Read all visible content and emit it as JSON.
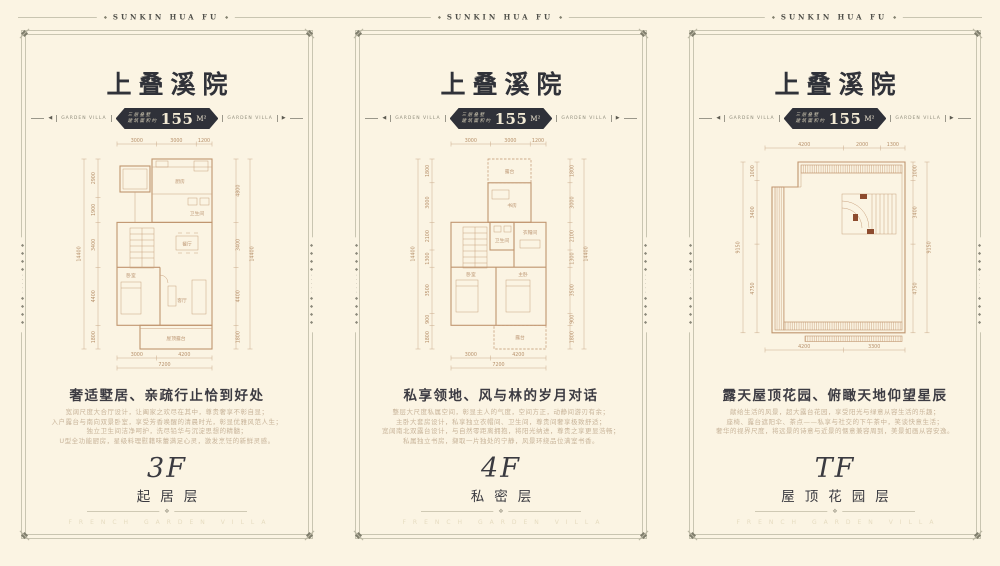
{
  "page": {
    "brand": "SUNKIN HUA FU",
    "icons": {
      "diamond": "◆",
      "left_arrow": "◀",
      "right_arrow": "▶",
      "divider_ornament": "❖",
      "side_ornament": "◆◆◆◆·····◆◆◆◆"
    }
  },
  "panels": [
    {
      "title": "上叠溪院",
      "side_label": "GARDEN VILLA",
      "badge": {
        "line1": "三层叠墅",
        "line2": "建筑面积约",
        "area": "155",
        "unit": "M²"
      },
      "headline": "奢适墅居、亲疏行止恰到好处",
      "body": [
        "宽阔尺度大合厅设计，让阖家之欢尽在其中，尊贵奢享不彰自显；",
        "入户露台与南向双景卧室，享受芳香唤醒的清晨时光，彰显优雅风范人生；",
        "独立卫生间洁净呵护，洗尽铅华与沉淀思想的精髓；",
        "U型全功能厨房，星级料理慰藉味蕾满足心灵，激发烹饪的新鲜灵感。"
      ],
      "floor_code": "3F",
      "floor_name": "起居层",
      "caption": "FRENCH GARDEN VILLA",
      "plan": {
        "top": [
          "3000",
          "3000",
          "1200"
        ],
        "left_total": "14400",
        "left": [
          "2900",
          "1900",
          "3400",
          "4400",
          "1800"
        ],
        "right": [
          "4800",
          "3400",
          "4400",
          "1800"
        ],
        "right_total": "14400",
        "bottom": [
          "3000",
          "4200"
        ],
        "bottom_total": "7200",
        "rooms": [
          "厨房",
          "卫生间",
          "餐厅",
          "卧室",
          "客厅",
          "屋顶露台"
        ]
      }
    },
    {
      "title": "上叠溪院",
      "side_label": "GARDEN VILLA",
      "badge": {
        "line1": "三层叠墅",
        "line2": "建筑面积约",
        "area": "155",
        "unit": "M²"
      },
      "headline": "私享领地、风与林的岁月对话",
      "body": [
        "整层大尺度私属空间，彰显主人的气度，空间方正，动静间游刃有余；",
        "主卧大套房设计，私享独立衣帽间、卫生间，尊贵间奢享极致舒适；",
        "宽阔南北双露台设计，与自然零距离拥抱，将阳光纳进，尊贵之享更显浩畅；",
        "私属独立书房，撷取一片独处的宁静，风景环绕品位满室书香。"
      ],
      "floor_code": "4F",
      "floor_name": "私密层",
      "caption": "FRENCH GARDEN VILLA",
      "plan": {
        "top": [
          "3000",
          "3000",
          "1200"
        ],
        "left_total": "14400",
        "left": [
          "1800",
          "3000",
          "2100",
          "1300",
          "3500",
          "900",
          "1800"
        ],
        "right": [
          "1800",
          "3000",
          "2100",
          "1300",
          "3500",
          "900",
          "1800"
        ],
        "right_total": "14400",
        "bottom": [
          "3000",
          "4200"
        ],
        "bottom_total": "7200",
        "rooms": [
          "露台",
          "书房",
          "卫生间",
          "衣帽间",
          "卧室",
          "主卧",
          "露台"
        ]
      }
    },
    {
      "title": "上叠溪院",
      "side_label": "GARDEN VILLA",
      "badge": {
        "line1": "三层叠墅",
        "line2": "建筑面积约",
        "area": "155",
        "unit": "M²"
      },
      "headline": "露天屋顶花园、俯瞰天地仰望星辰",
      "body": [
        "献给生活的风景，超大露台花园，享受阳光与绿意从容生活的乐趣；",
        "座椅、露台遮阳伞、茶点——私享与社交的下午茶中，笑谈快意生活；",
        "奢华的视界尺度，将远景的诗意与近景的惬意兼容周到，美景如画从容安逸。"
      ],
      "floor_code": "TF",
      "floor_name": "屋顶花园层",
      "caption": "FRENCH GARDEN VILLA",
      "plan": {
        "top": [
          "4200",
          "2000",
          "1300"
        ],
        "left_total": "9150",
        "left": [
          "1000",
          "3400",
          "4750"
        ],
        "right": [
          "1000",
          "3400",
          "4750"
        ],
        "right_total": "9150",
        "bottom": [
          "4200",
          "3300"
        ],
        "rooms": []
      }
    }
  ]
}
